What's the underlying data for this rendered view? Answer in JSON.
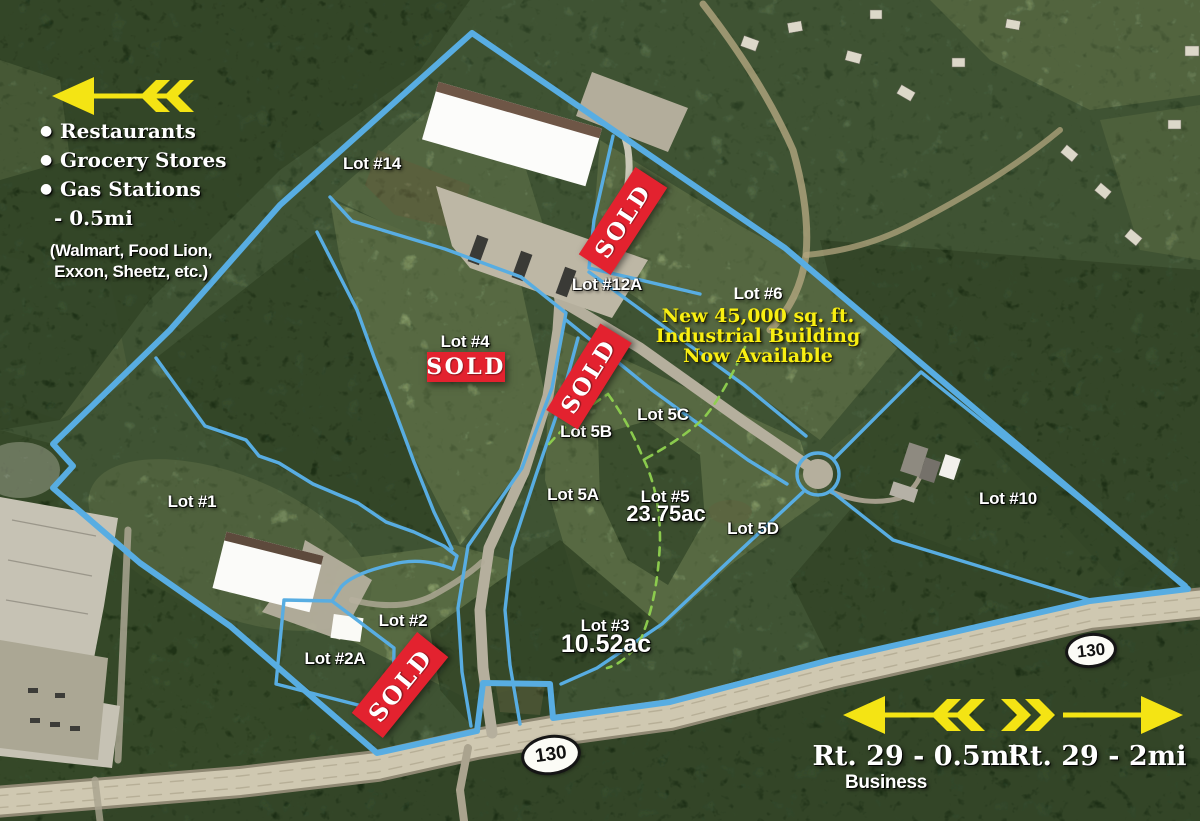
{
  "legend": {
    "items": [
      "Restaurants",
      "Grocery Stores",
      "Gas Stations"
    ],
    "distance": "- 0.5mi",
    "note1": "(Walmart, Food Lion,",
    "note2": "Exxon, Sheetz, etc.)"
  },
  "promo": {
    "lot": "Lot #6",
    "line1": "New 45,000 sq. ft.",
    "line2": "Industrial Building",
    "line3": "Now Available"
  },
  "sold_label": "SOLD",
  "route_shield": "130",
  "directions": {
    "left": "Rt. 29 - 0.5mi",
    "left_sub": "Business",
    "right": "Rt. 29 - 2mi"
  },
  "lots": {
    "lot14": "Lot #14",
    "lot12a": "Lot #12A",
    "lot4": "Lot #4",
    "lot5c": "Lot 5C",
    "lot5b": "Lot 5B",
    "lot5a": "Lot 5A",
    "lot5": "Lot #5",
    "lot5_acreage": "23.75ac",
    "lot5d": "Lot 5D",
    "lot1": "Lot #1",
    "lot10": "Lot #10",
    "lot2": "Lot #2",
    "lot2a": "Lot #2A",
    "lot3": "Lot #3",
    "lot3_acreage": "10.52ac"
  },
  "colors": {
    "boundary_blue": "#58ade2",
    "sold_red": "#e3222f",
    "highlight_yellow": "#f4e414",
    "dashed_green": "#8fd14f"
  }
}
